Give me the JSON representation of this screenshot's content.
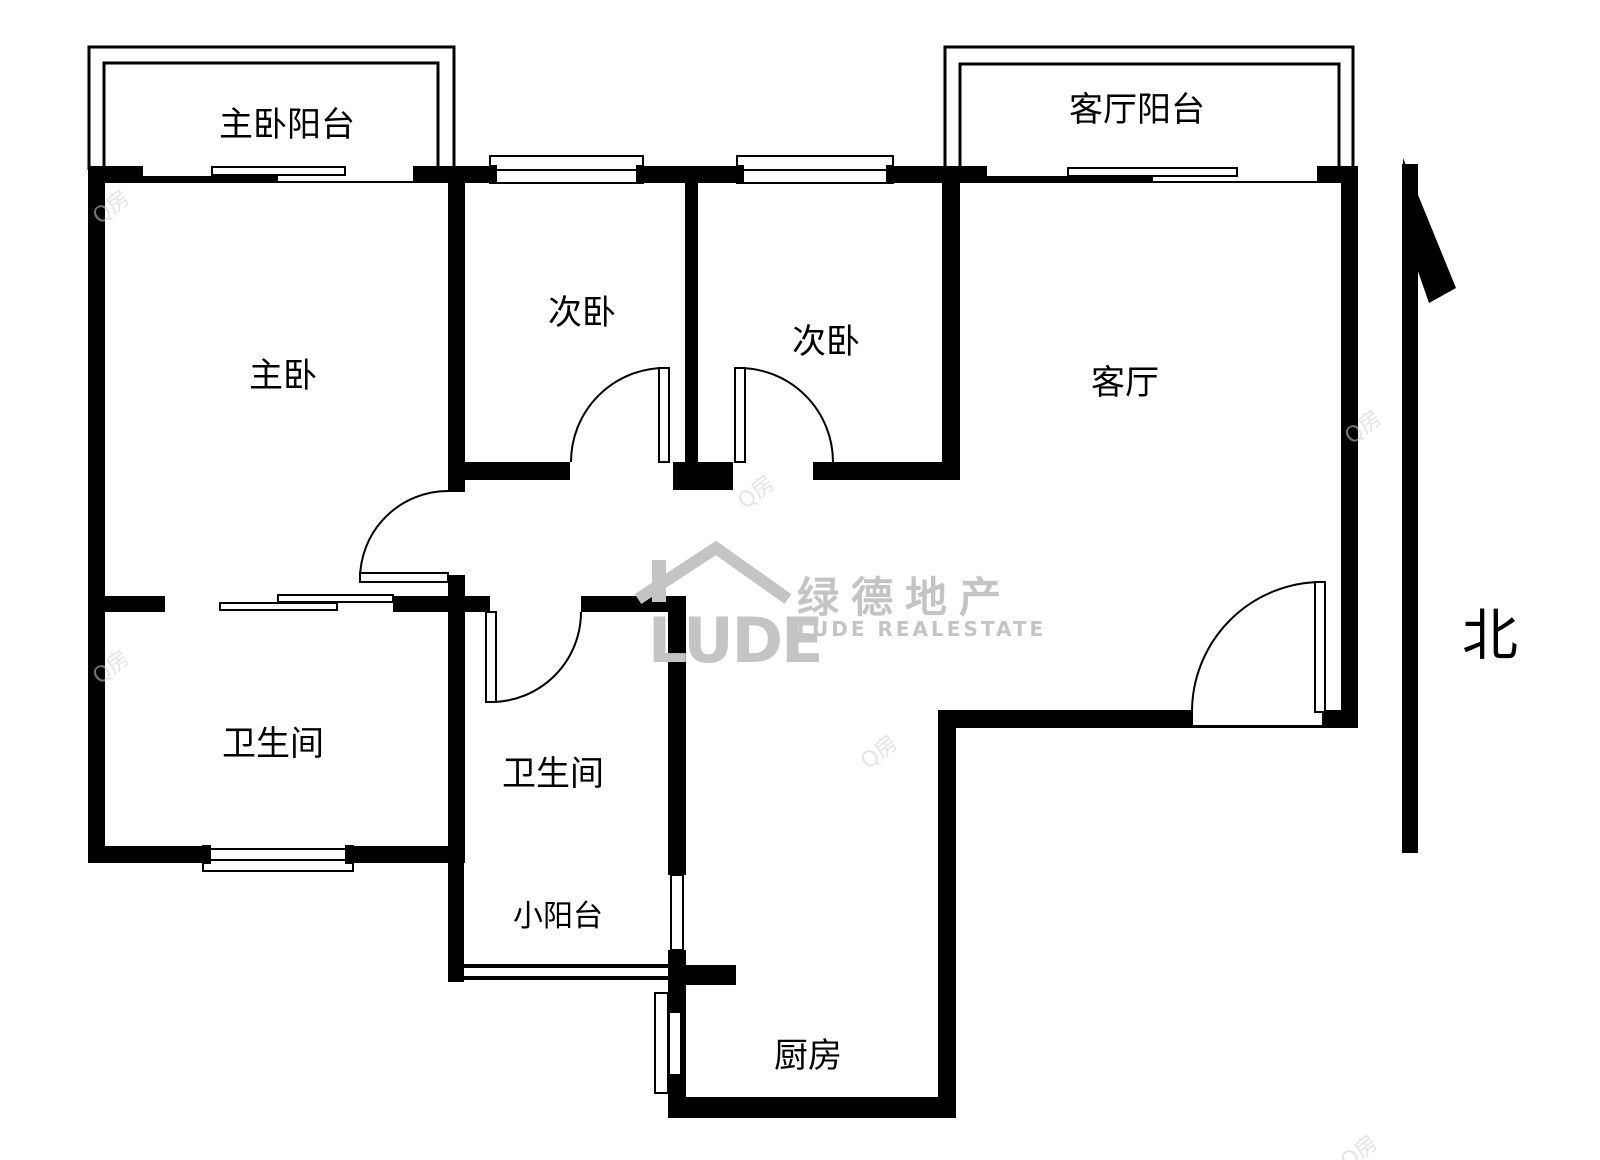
{
  "page": {
    "background": "#ffffff"
  },
  "colors": {
    "wall": "#000000",
    "line": "#000000",
    "watermark_gray": "#c4c4c4",
    "tile_gray": "#cfcfcf"
  },
  "rooms": {
    "master_balcony": "主卧阳台",
    "living_balcony": "客厅阳台",
    "bedroom_left": "次卧",
    "bedroom_right": "次卧",
    "master_bedroom": "主卧",
    "living_room": "客厅",
    "bathroom_left": "卫生间",
    "bathroom_mid": "卫生间",
    "small_balcony": "小阳台",
    "kitchen": "厨房"
  },
  "compass": {
    "north": "北"
  },
  "logo": {
    "brand": "LUDE",
    "brand_cn": "绿德地产",
    "brand_en": "LUDE REALESTATE"
  },
  "watermark_tile": "Q房"
}
